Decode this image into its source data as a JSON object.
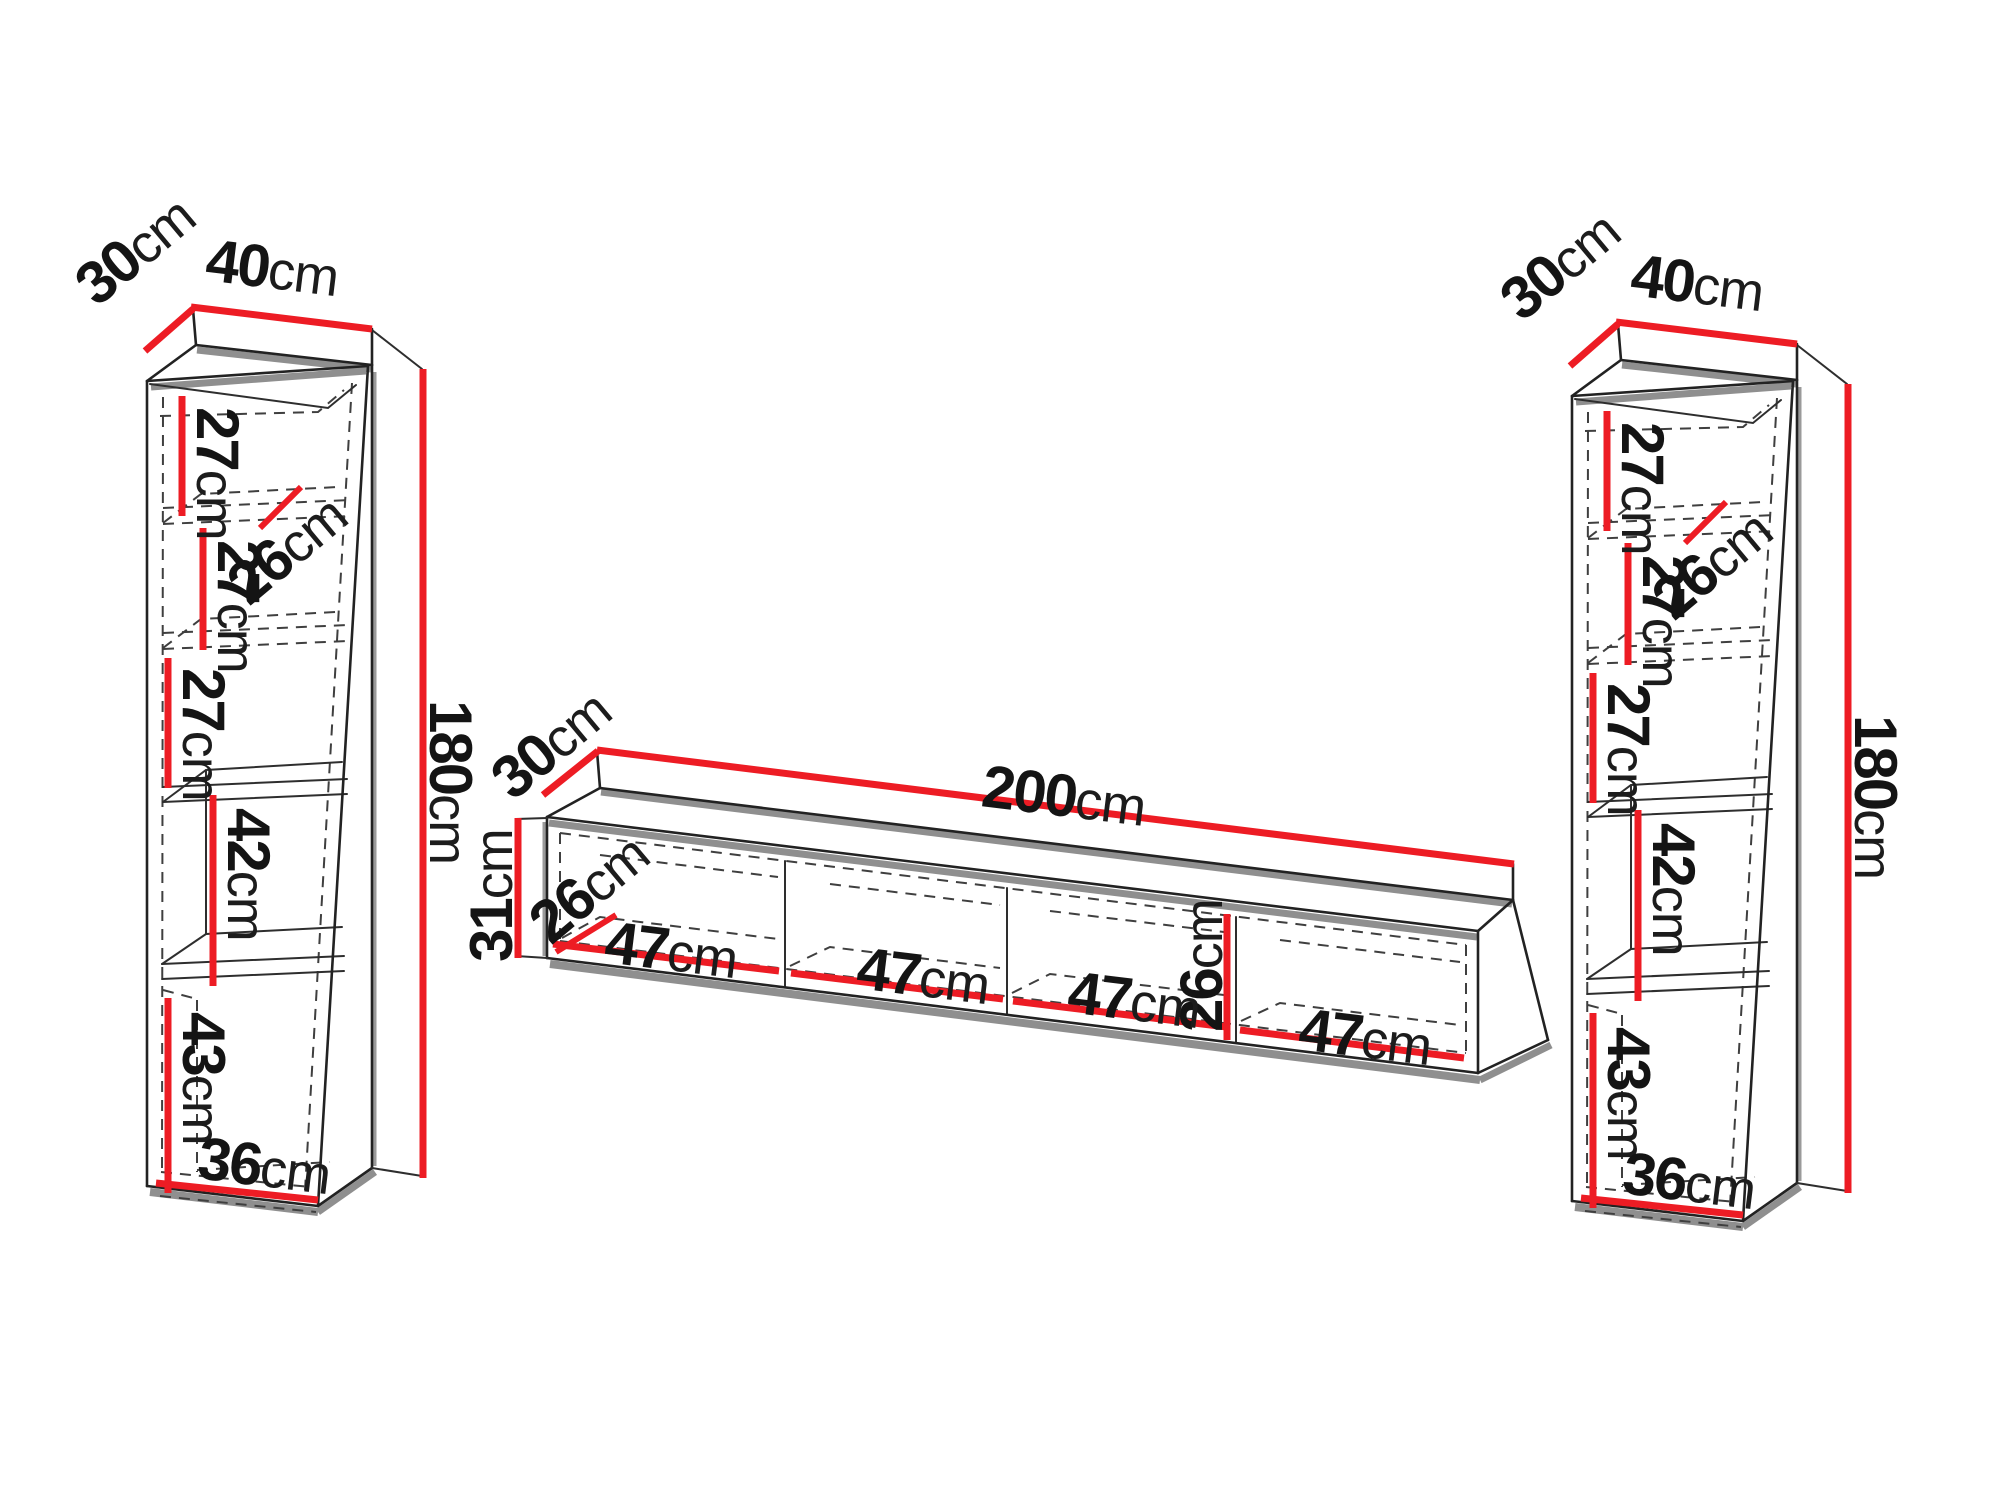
{
  "accent_red": "#ED1C24",
  "left_column": {
    "depth": {
      "value": "30",
      "unit": "cm"
    },
    "width": {
      "value": "40",
      "unit": "cm"
    },
    "height": {
      "value": "180",
      "unit": "cm"
    },
    "shelf1": {
      "value": "27",
      "unit": "cm"
    },
    "shelf_depth": {
      "value": "26",
      "unit": "cm"
    },
    "shelf2": {
      "value": "27",
      "unit": "cm"
    },
    "shelf3": {
      "value": "27",
      "unit": "cm"
    },
    "niche": {
      "value": "42",
      "unit": "cm"
    },
    "bottom": {
      "value": "43",
      "unit": "cm"
    },
    "inner_width": {
      "value": "36",
      "unit": "cm"
    }
  },
  "tv_stand": {
    "depth": {
      "value": "30",
      "unit": "cm"
    },
    "width": {
      "value": "200",
      "unit": "cm"
    },
    "height": {
      "value": "31",
      "unit": "cm"
    },
    "inner_depth": {
      "value": "26",
      "unit": "cm"
    },
    "inner_height": {
      "value": "26",
      "unit": "cm"
    },
    "compartment1": {
      "value": "47",
      "unit": "cm"
    },
    "compartment2": {
      "value": "47",
      "unit": "cm"
    },
    "compartment3": {
      "value": "47",
      "unit": "cm"
    },
    "compartment4": {
      "value": "47",
      "unit": "cm"
    }
  },
  "right_column": {
    "depth": {
      "value": "30",
      "unit": "cm"
    },
    "width": {
      "value": "40",
      "unit": "cm"
    },
    "height": {
      "value": "180",
      "unit": "cm"
    },
    "shelf1": {
      "value": "27",
      "unit": "cm"
    },
    "shelf_depth": {
      "value": "26",
      "unit": "cm"
    },
    "shelf2": {
      "value": "27",
      "unit": "cm"
    },
    "shelf3": {
      "value": "27",
      "unit": "cm"
    },
    "niche": {
      "value": "42",
      "unit": "cm"
    },
    "bottom": {
      "value": "43",
      "unit": "cm"
    },
    "inner_width": {
      "value": "36",
      "unit": "cm"
    }
  }
}
